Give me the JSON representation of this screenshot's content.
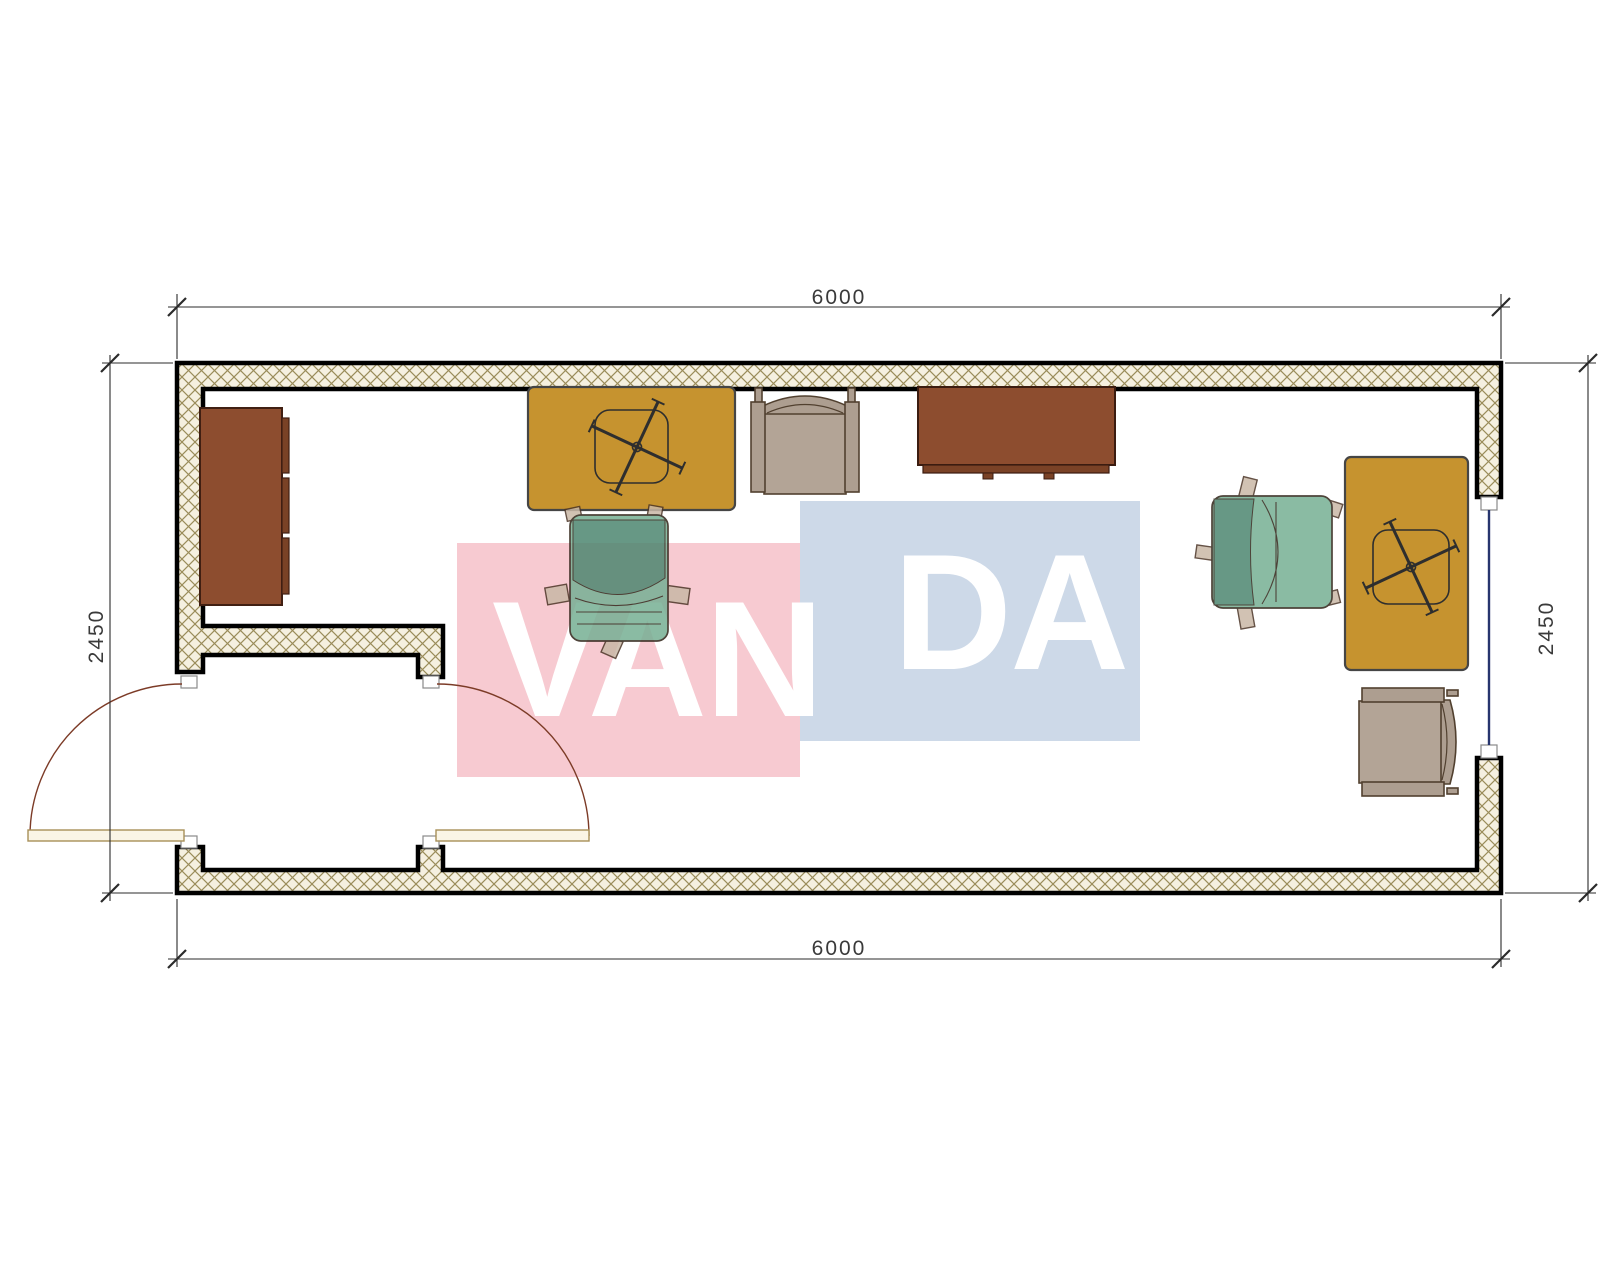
{
  "dimensions": {
    "top": "6000",
    "bottom": "6000",
    "left": "2450",
    "right": "2450"
  },
  "watermark": {
    "left_text": "VAN",
    "right_text": "DA",
    "pink_color": "#f7cad1",
    "blue_color": "#cdd9e8",
    "text_color": "#ffffff"
  },
  "plan": {
    "wall_hatch_background": "#f5f0e0",
    "wall_hatch_line_color": "#9a8c5a",
    "wall_outline_color": "#000000",
    "window_glazing_color": "#27356e",
    "door_swing_color": "#7c3b27",
    "door_leaf_fill": "#faf5e6",
    "desk_color": "#c6932f",
    "cabinet_color": "#8d4d2f",
    "armchair_color": "#ad9e90",
    "office_chair_seat_color": "#76b094",
    "office_chair_back_color": "#4d8770"
  },
  "furniture": [
    {
      "name": "side-cabinet"
    },
    {
      "name": "desk-left"
    },
    {
      "name": "desk-right"
    },
    {
      "name": "visitor-armchair-top"
    },
    {
      "name": "visitor-armchair-bottom"
    },
    {
      "name": "office-chair-left"
    },
    {
      "name": "office-chair-right"
    },
    {
      "name": "sideboard-table"
    }
  ]
}
